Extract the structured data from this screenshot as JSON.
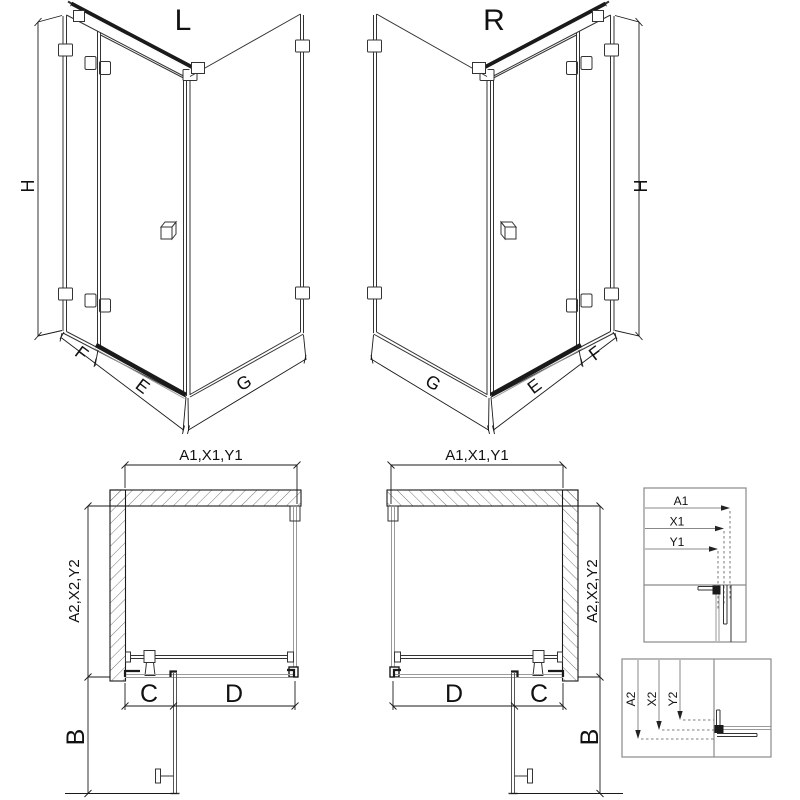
{
  "page": {
    "background": "#ffffff"
  },
  "colors": {
    "line": "#1a1a1a",
    "geometry": "#333333",
    "glass_edge": "#9a9a9a",
    "detail_frame": "#8a8a8a",
    "arrow": "#222222"
  },
  "views": {
    "iso_left": {
      "label": "L",
      "height": "H",
      "fixed_width": "F",
      "door_width": "E",
      "return_width": "G"
    },
    "iso_right": {
      "label": "R",
      "height": "H",
      "fixed_width": "F",
      "door_width": "E",
      "return_width": "G"
    },
    "plan_left": {
      "width": "A1,X1,Y1",
      "depth": "A2,X2,Y2",
      "fixed": "C",
      "door": "D",
      "swing": "B"
    },
    "plan_right": {
      "width": "A1,X1,Y1",
      "depth": "A2,X2,Y2",
      "fixed": "C",
      "door": "D",
      "swing": "B"
    },
    "detail_width": {
      "labels": [
        "A1",
        "X1",
        "Y1"
      ]
    },
    "detail_depth": {
      "labels": [
        "A2",
        "X2",
        "Y2"
      ]
    }
  }
}
